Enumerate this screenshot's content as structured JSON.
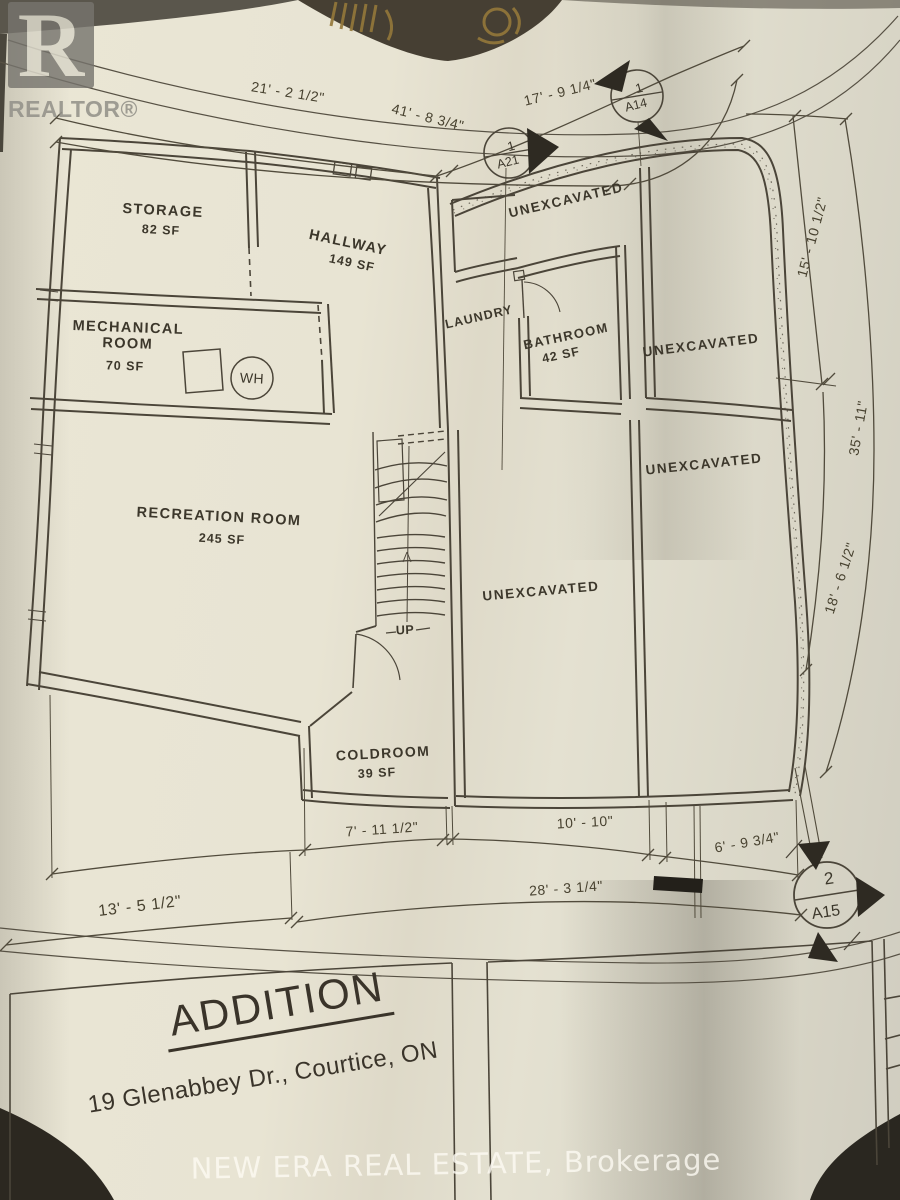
{
  "branding": {
    "realtor_logo_letter": "R",
    "realtor_logo_text": "REALTOR®",
    "bottom_watermark": "NEW ERA REAL ESTATE, Brokerage"
  },
  "title_block": {
    "project_title": "ADDITION",
    "project_address": "19 Glenabbey Dr., Courtice, ON"
  },
  "rooms": [
    {
      "name": "STORAGE",
      "area": "82 SF"
    },
    {
      "name": "HALLWAY",
      "area": "149 SF"
    },
    {
      "name": "MECHANICAL ROOM",
      "area": "70 SF"
    },
    {
      "name": "RECREATION ROOM",
      "area": "245 SF"
    },
    {
      "name": "LAUNDRY",
      "area": ""
    },
    {
      "name": "BATHROOM",
      "area": "42 SF"
    },
    {
      "name": "COLDROOM",
      "area": "39 SF"
    }
  ],
  "unexcavated": [
    "UNEXCAVATED",
    "UNEXCAVATED",
    "UNEXCAVATED",
    "UNEXCAVATED"
  ],
  "stairs": {
    "direction_label": "UP"
  },
  "equipment": {
    "water_heater_label": "WH"
  },
  "dimensions": {
    "top_left": "21' - 2 1/2\"",
    "top_overall": "41' - 8 3/4\"",
    "top_right": "17' - 9 1/4\"",
    "right_upper": "15' - 10 1/2\"",
    "right_overall": "35' - 11\"",
    "right_lower": "18' - 6 1/2\"",
    "bottom_seg1": "7' - 11 1/2\"",
    "bottom_seg2": "10' - 10\"",
    "bottom_seg3": "6' - 9 3/4\"",
    "bottom_overall": "28' - 3 1/4\"",
    "bottom_left_offset": "13' - 5 1/2\""
  },
  "section_markers": [
    {
      "number": "1",
      "sheet": "A21"
    },
    {
      "number": "1",
      "sheet": "A14"
    },
    {
      "number": "2",
      "sheet": "A15"
    }
  ]
}
